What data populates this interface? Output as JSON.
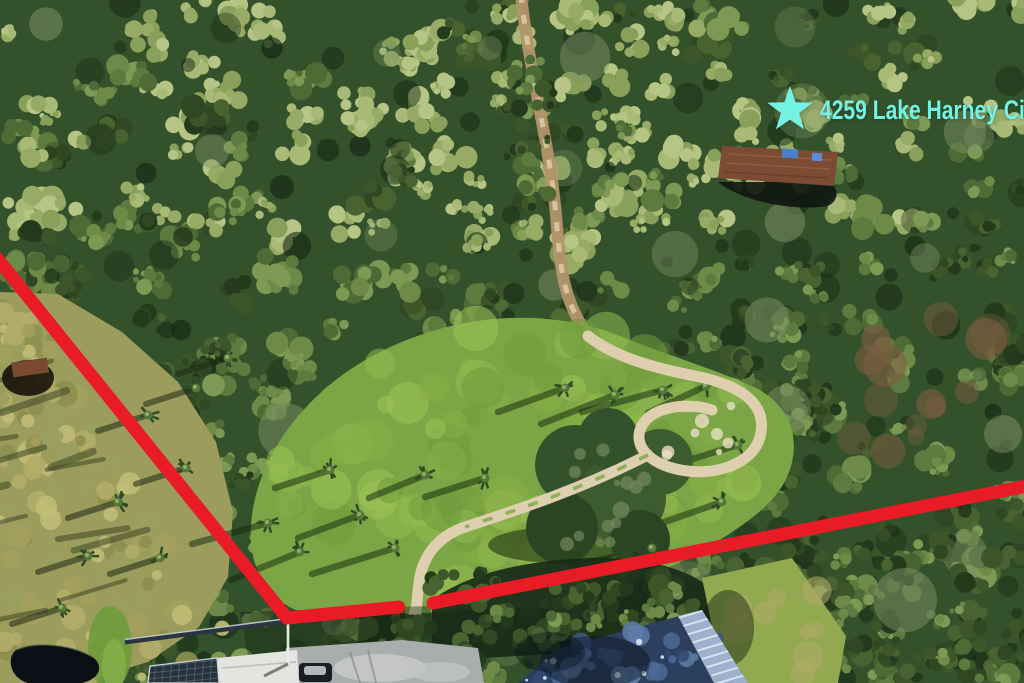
{
  "annotation": {
    "marker_icon": "star",
    "property_label": "4259 Lake Harney Cir",
    "colors": {
      "marker": "#74f2e4",
      "label": "#74f2e4",
      "boundary": "#e81b26"
    }
  }
}
